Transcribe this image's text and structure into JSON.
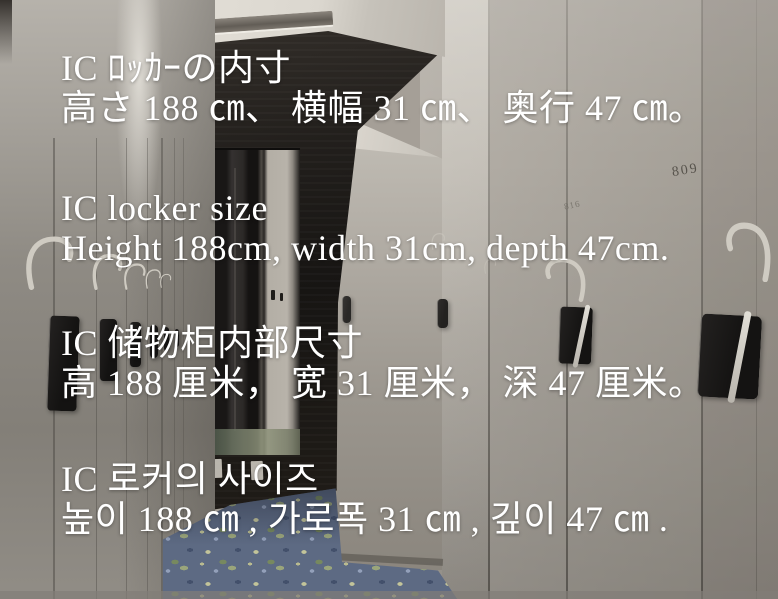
{
  "photo": {
    "locker_numbers": {
      "right_door": "809",
      "far_door": "816"
    },
    "colors": {
      "locker_cream": "#aba69e",
      "dark_wall": "#221f1c",
      "carpet_blue": "#5d6a83",
      "text": "#ffffff"
    }
  },
  "overlay": {
    "blocks": [
      {
        "lang": "japanese",
        "title": "IC ﾛｯｶｰの内寸",
        "dims": "高さ 188 ㎝、 横幅 31 ㎝、 奥行 47 ㎝。"
      },
      {
        "lang": "english",
        "title": "IC locker size",
        "dims": "Height 188cm, width 31cm, depth 47cm."
      },
      {
        "lang": "chinese",
        "title": "IC 储物柜内部尺寸",
        "dims": "高 188 厘米， 宽 31 厘米， 深 47 厘米。"
      },
      {
        "lang": "korean",
        "title": "IC 로커의 사이즈",
        "dims": "높이 188 ㎝ , 가로폭 31 ㎝ , 깊이 47 ㎝ ."
      }
    ]
  }
}
